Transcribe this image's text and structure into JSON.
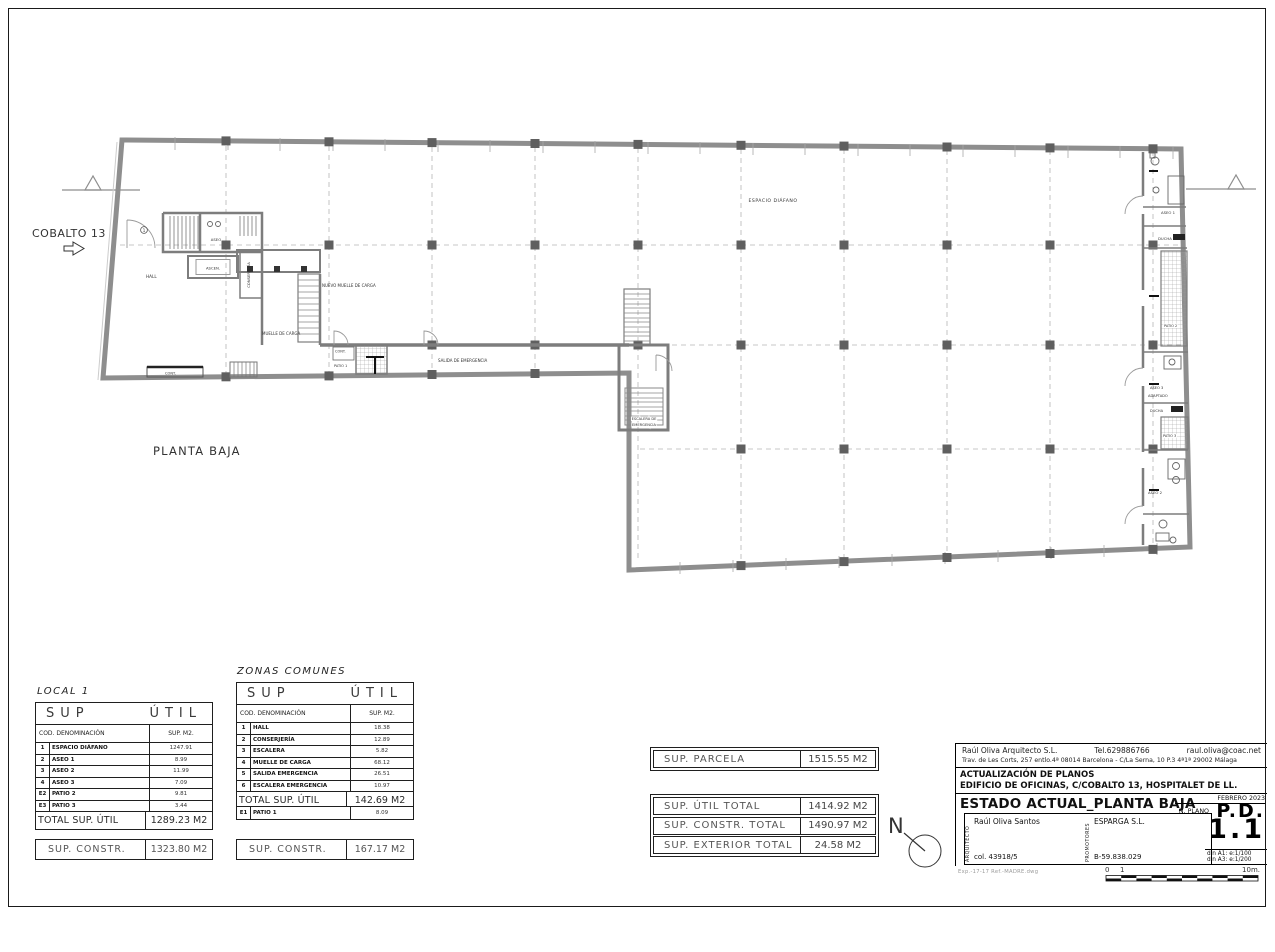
{
  "colors": {
    "ink": "#1a1a1a",
    "wall_gray": "#8e8e8e",
    "column_gray": "#5f5f5f",
    "hatch_gray": "#9a9a9a",
    "label_gray": "#555555"
  },
  "sheet": {
    "street_label": "COBALTO 13",
    "plan_title": "PLANTA BAJA",
    "north_label": "N"
  },
  "plan": {
    "labels": {
      "hall": "HALL",
      "entrance_number": "1",
      "aseo": "ASEO",
      "ascen": "ASCEN.",
      "conserjeria": "CONSERJERÍA",
      "nuevo_muelle": "NUEVO MUELLE DE CARGA",
      "muelle": "MUELLE DE CARGA",
      "salida": "SALIDA DE EMERGENCIA",
      "cont_left": "CONT.",
      "cont_patio": "CONT.",
      "patio1": "PATIO 1",
      "escalera_line1": "ESCALERA DE",
      "escalera_line2": "EMERGENCIA",
      "espacio": "ESPACIO DIÁFANO",
      "aseo1": "ASEO 1",
      "ducha_top": "DUCHA",
      "patio2": "PATIO 2",
      "aseo3_line1": "ASEO 3",
      "aseo3_line2": "ADAPTADO",
      "ducha_mid": "DUCHA",
      "patio3": "PATIO 3",
      "aseo2": "ASEO 2"
    }
  },
  "tables": {
    "local1": {
      "title": "LOCAL 1",
      "header_sup": "SUP",
      "header_util": "ÚTIL",
      "col_den": "COD. DENOMINACIÓN",
      "col_sup": "SUP. M2.",
      "rows": [
        {
          "cod": "1",
          "den": "ESPACIO DIÁFANO",
          "sup": "1247.91"
        },
        {
          "cod": "2",
          "den": "ASEO 1",
          "sup": "8.99"
        },
        {
          "cod": "3",
          "den": "ASEO 2",
          "sup": "11.99"
        },
        {
          "cod": "4",
          "den": "ASEO 3",
          "sup": "7.09"
        },
        {
          "cod": "E2",
          "den": "PATIO 2",
          "sup": "9.81"
        },
        {
          "cod": "E3",
          "den": "PATIO 3",
          "sup": "3.44"
        }
      ],
      "total_label": "TOTAL SUP. ÚTIL",
      "total_value": "1289.23 M2",
      "constr_label": "SUP. CONSTR.",
      "constr_value": "1323.80 M2"
    },
    "comunes": {
      "title": "ZONAS COMUNES",
      "header_sup": "SUP",
      "header_util": "ÚTIL",
      "col_den": "COD. DENOMINACIÓN",
      "col_sup": "SUP. M2.",
      "rows": [
        {
          "cod": "1",
          "den": "HALL",
          "sup": "18.38"
        },
        {
          "cod": "2",
          "den": "CONSERJERÍA",
          "sup": "12.89"
        },
        {
          "cod": "3",
          "den": "ESCALERA",
          "sup": "5.82"
        },
        {
          "cod": "4",
          "den": "MUELLE DE CARGA",
          "sup": "68.12"
        },
        {
          "cod": "5",
          "den": "SALIDA EMERGENCIA",
          "sup": "26.51"
        },
        {
          "cod": "6",
          "den": "ESCALERA EMERGENCIA",
          "sup": "10.97"
        }
      ],
      "total_label": "TOTAL SUP. ÚTIL",
      "total_value": "142.69 M2",
      "extra_row": {
        "cod": "E1",
        "den": "PATIO 1",
        "sup": "8.09"
      },
      "constr_label": "SUP. CONSTR.",
      "constr_value": "167.17 M2"
    }
  },
  "summary": {
    "parcela_label": "SUP. PARCELA",
    "parcela_value": "1515.55 M2",
    "rows": [
      {
        "label": "SUP. ÚTIL TOTAL",
        "value": "1414.92 M2"
      },
      {
        "label": "SUP. CONSTR. TOTAL",
        "value": "1490.97 M2"
      },
      {
        "label": "SUP. EXTERIOR TOTAL",
        "value": "24.58 M2"
      }
    ]
  },
  "titleblock": {
    "architect_name": "Raúl Oliva Arquitecto S.L.",
    "phone": "Tel.629886766",
    "email": "raul.oliva@coac.net",
    "address": "Trav. de Les Corts, 257 entlo.4ª 08014 Barcelona  -  C/La Serna, 10 P.3 4ª1ª 29002 Málaga",
    "project_line1": "ACTUALIZACIÓN DE PLANOS",
    "project_line2": "EDIFICIO DE OFICINAS, C/COBALTO 13, HOSPITALET DE LL.",
    "sheet_title": "ESTADO ACTUAL_PLANTA BAJA",
    "date": "FEBRERO 2023",
    "n_plano_label": "N. PLANO",
    "plan_code_prefix": "P.D.",
    "plan_code_number": "1.1",
    "scale_a1": "din A1: e:1/100",
    "scale_a3": "din A3: e:1/200",
    "arquitecto_label": "ARQUITECTO",
    "arquitecto_name": "Raúl Oliva Santos",
    "arquitecto_col": "col. 43918/5",
    "promotores_label": "PROMOTORES",
    "promotores_name": "ESPARGA S.L.",
    "promotores_cif": "B-59.838.029",
    "file_ref": "Exp.-17-17    Ref.-MADRE.dwg",
    "scalebar": {
      "zero": "0",
      "one": "1",
      "end": "10m."
    }
  }
}
